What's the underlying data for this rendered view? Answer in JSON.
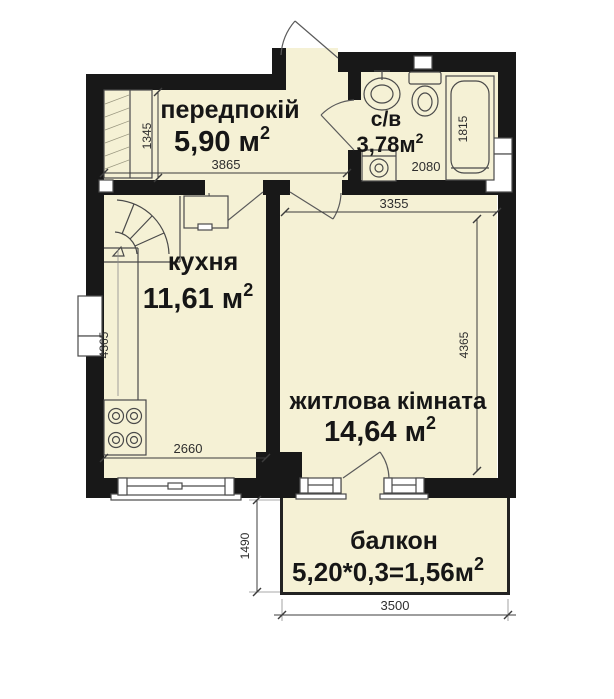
{
  "colors": {
    "room_fill": "#f5f1d5",
    "wall": "#181818",
    "fixture": "#4a4a4a",
    "dim": "#3c3c3c",
    "text": "#161616"
  },
  "superscript": "2",
  "rooms": {
    "hallway": {
      "label": "передпокій",
      "area": "5,90 м"
    },
    "bathroom": {
      "label": "с/в",
      "area": "3,78м"
    },
    "kitchen": {
      "label": "кухня",
      "area": "11,61 м"
    },
    "living_room": {
      "label": "житлова кімната",
      "area": "14,64 м"
    },
    "balcony": {
      "label": "балкон",
      "area_formula": "5,20*0,3=1,56м"
    }
  },
  "dimensions": {
    "hallway_width": "3865",
    "closet_depth": "1345",
    "bathroom_width": "2080",
    "bathroom_depth": "1815",
    "kitchen_width": "2660",
    "kitchen_height": "4365",
    "living_width": "3355",
    "living_height": "4365",
    "balcony_width": "3500",
    "balcony_depth": "1490"
  }
}
